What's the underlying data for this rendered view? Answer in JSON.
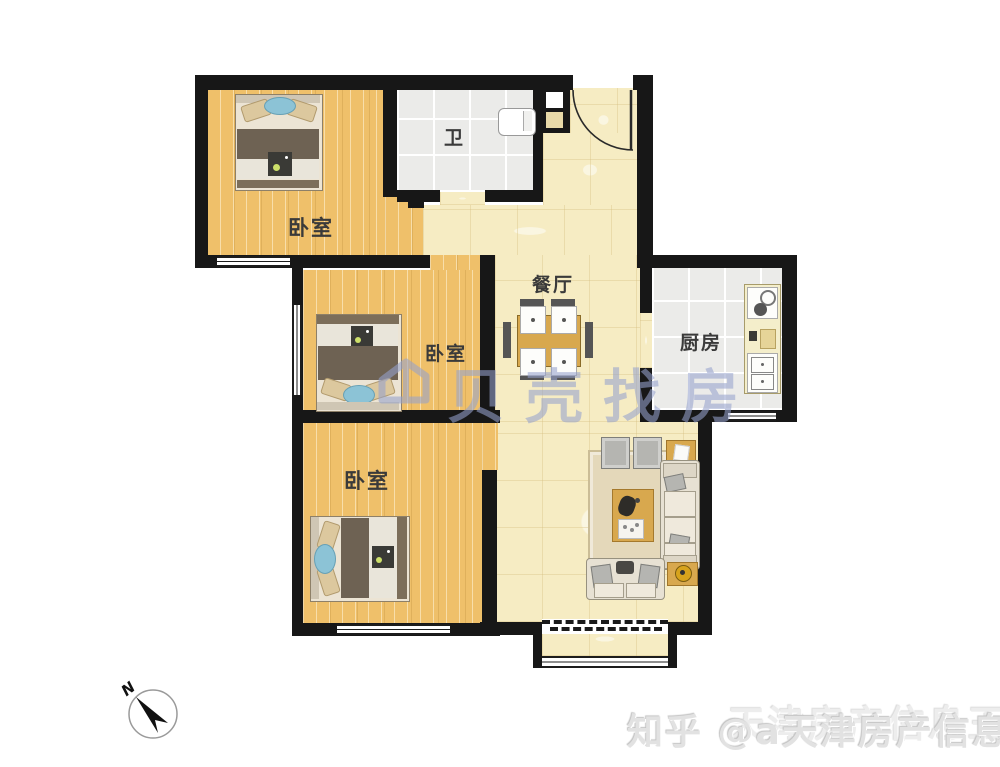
{
  "meta": {
    "type": "apartment-floor-plan",
    "canvas_width": 1000,
    "canvas_height": 767
  },
  "rooms": {
    "bedroom_top_left": {
      "label": "卧室"
    },
    "bedroom_middle": {
      "label": "卧室"
    },
    "bedroom_bottom": {
      "label": "卧室"
    },
    "bathroom": {
      "label": "卫"
    },
    "dining": {
      "label": "餐厅"
    },
    "kitchen": {
      "label": "厨房"
    }
  },
  "watermarks": {
    "center_brand": {
      "text": "贝壳找房",
      "logo": "beike-house-logo",
      "color": "#96a2cd"
    },
    "corner": {
      "line1": "知乎 @a天津房产信息王",
      "line2_overlap": "天津房产信息王",
      "color": "#e2e2e2"
    }
  },
  "compass": {
    "label": "N"
  },
  "palette": {
    "wall": "#171717",
    "wood_floor": "#efc06a",
    "hall_tile": "#f6ecc3",
    "wet_tile": "#ebebe9",
    "bed_accent_blue": "#8cc3d6",
    "furniture_wood": "#d8a84e",
    "sofa_cream": "#e7e1d3"
  }
}
